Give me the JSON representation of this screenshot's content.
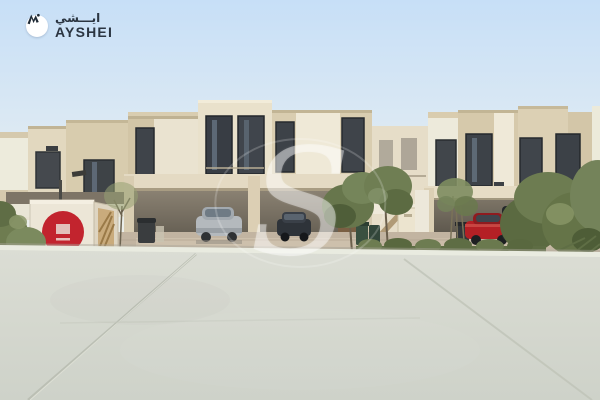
{
  "branding": {
    "latin": "AYSHEI",
    "arabic": "ايـــشي",
    "mark_icon": "ayshei-logomark-icon",
    "text_color": "#2b3541",
    "badge_bg": "#ffffff"
  },
  "watermark": {
    "letter": "S"
  },
  "scene": {
    "description": "Street view of a row of modern beige two-storey townhouses with covered carports, parked cars (silver SUV, dark sedan, red saloon, dark SUV), a white delivery truck with a red circular logo, young trees, wheelie bins, a lamp post and a wide light-grey concrete forecourt under a pale blue sky",
    "colors": {
      "sky_top": "#c9e0f7",
      "sky_horizon": "#f0efe4",
      "wall_cream": "#d8cbae",
      "panel_light": "#ece7d6",
      "window_dark": "#3d4248",
      "carport_shadow": "#5e574c",
      "paver_street": "#c2b4a1",
      "concrete": "#d5d8d0",
      "concrete_edge": "#e9ebe0",
      "foliage": "#66754a",
      "truck_body": "#ede7d8",
      "truck_logo_red": "#c2242e",
      "car_silver": "#b6babe",
      "car_dark": "#2d3237",
      "car_red": "#b42025"
    }
  }
}
